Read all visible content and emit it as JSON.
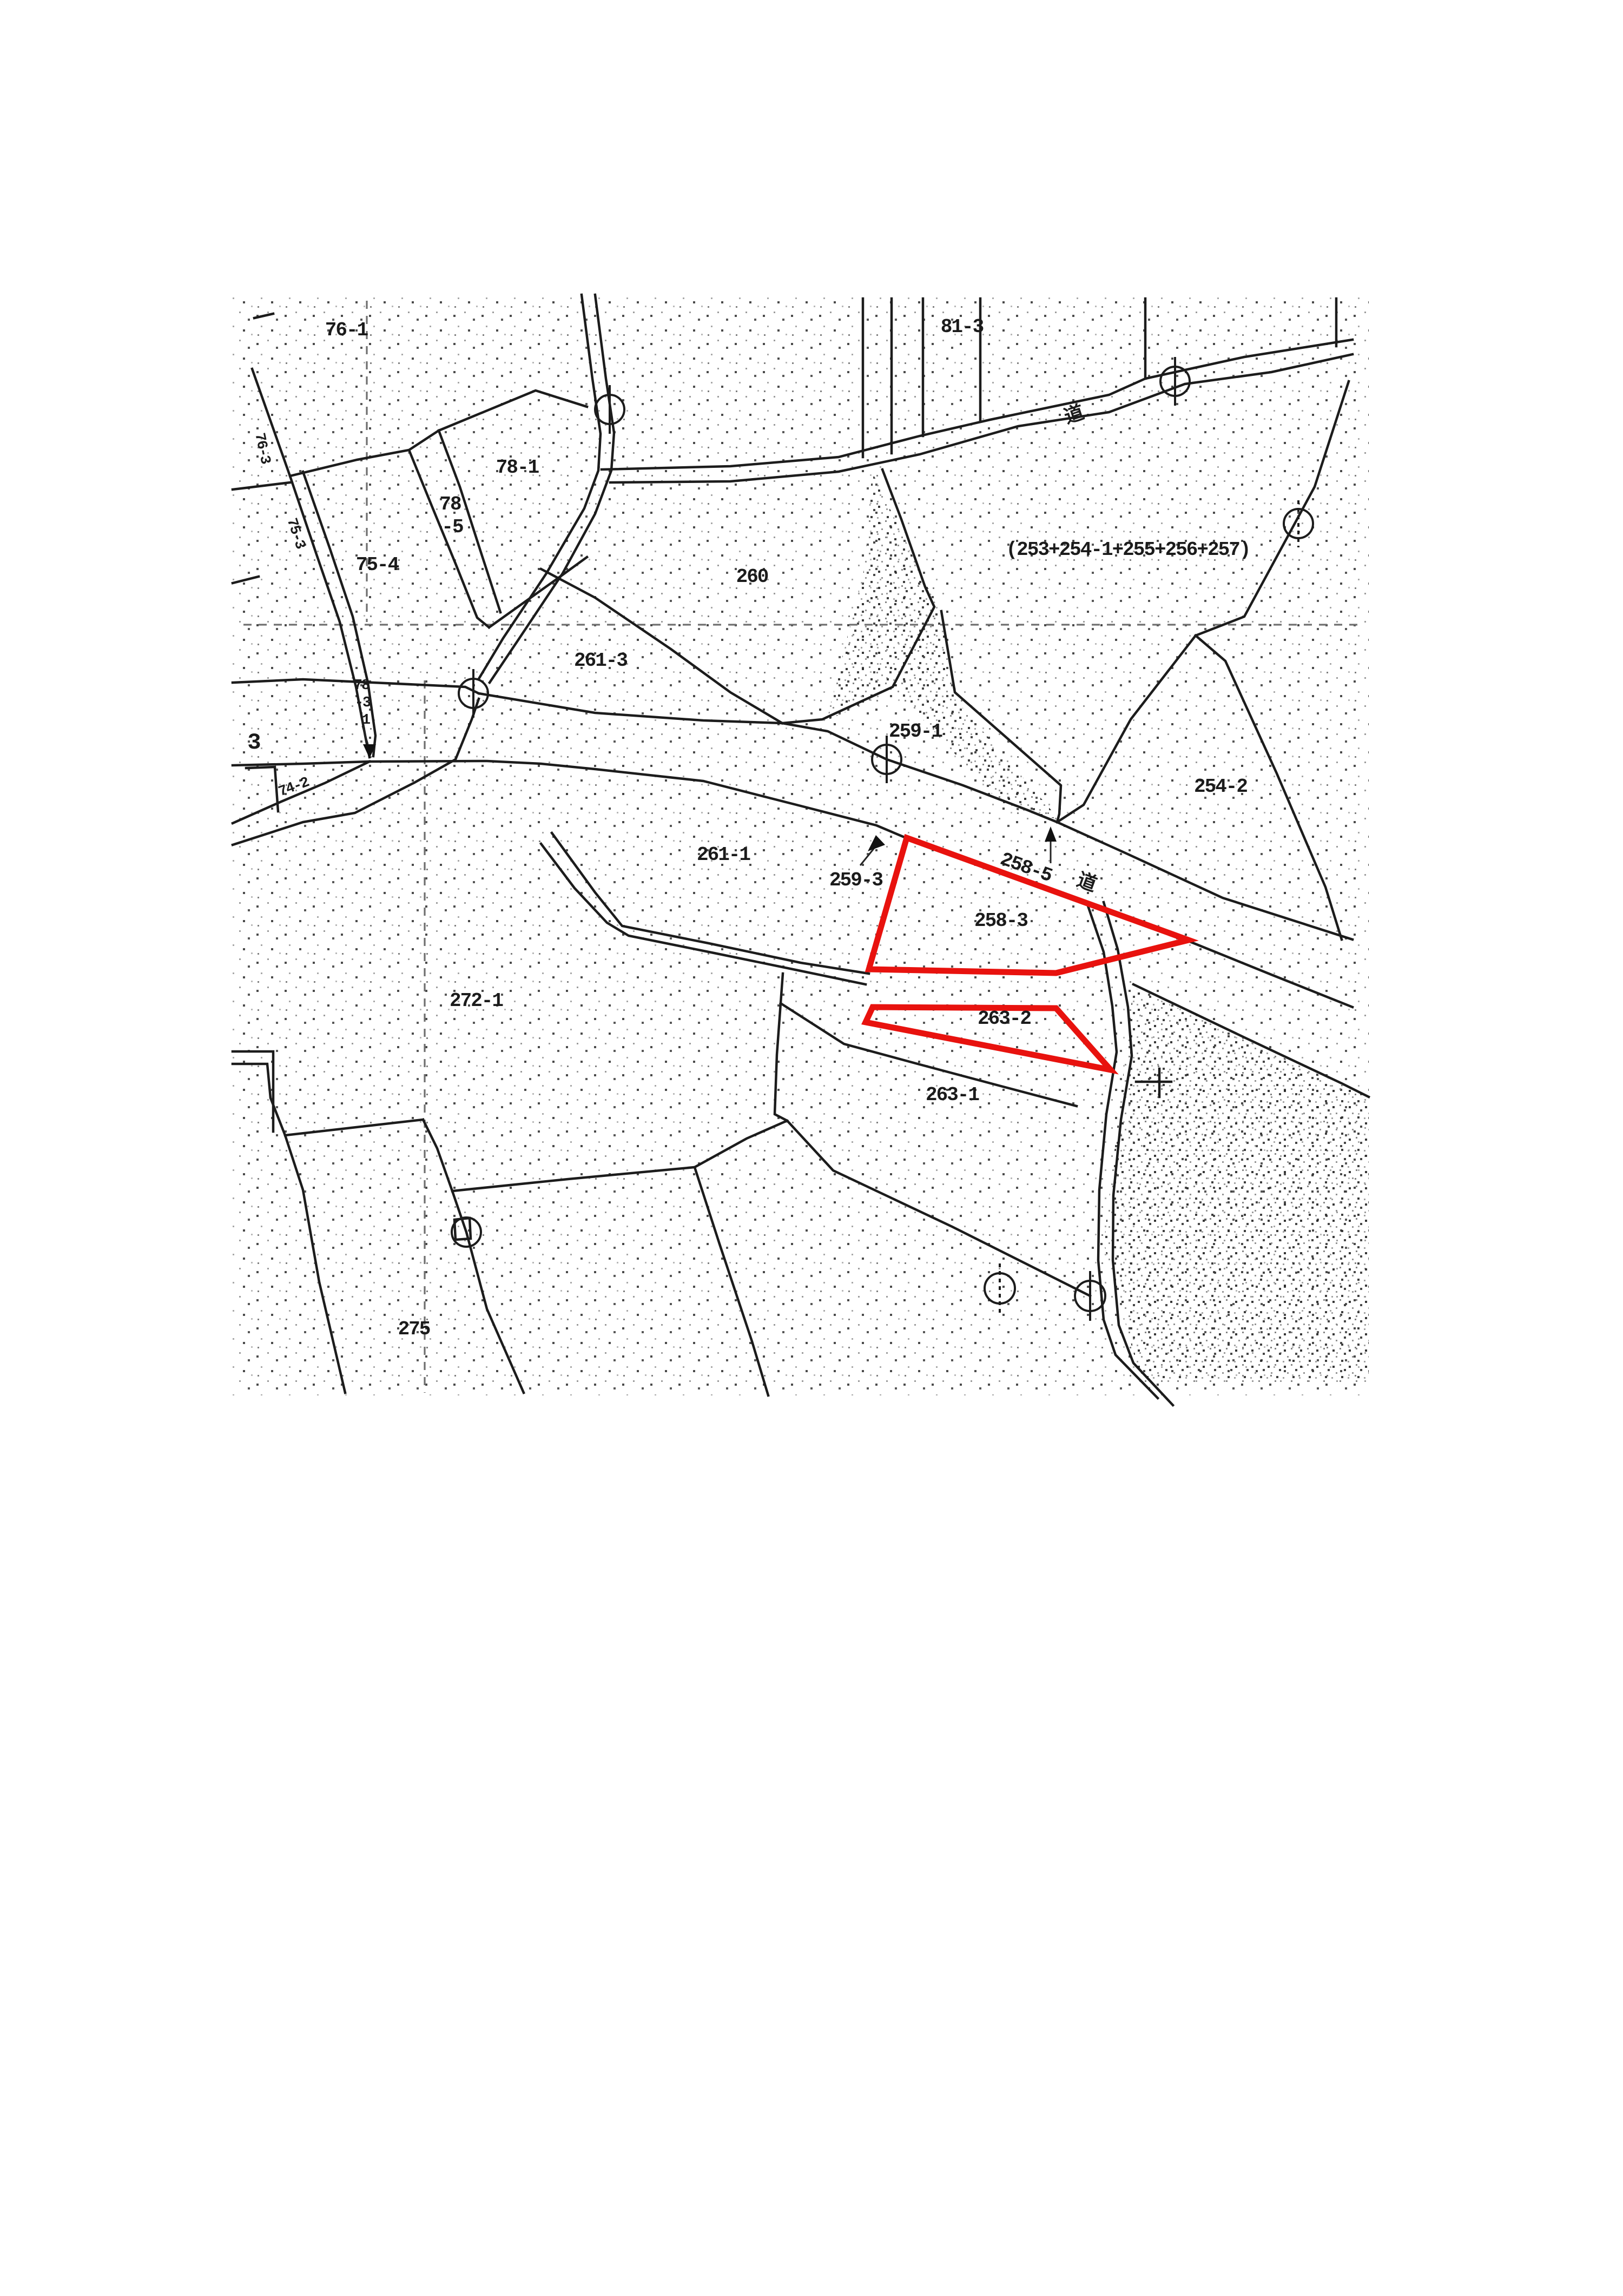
{
  "document": {
    "kind": "cadastral parcel map scan (公図)",
    "background_color": "#ffffff",
    "ink_color": "#1c1c1c",
    "highlight_color": "#e8120e",
    "highlighted_parcels": [
      "258-3",
      "263-2"
    ],
    "road_kanji": "道",
    "parcel_numbers": [
      "76-1",
      "81-3",
      "78-1",
      "78-5",
      "75-4",
      "76-3",
      "75-3",
      "260",
      "(253+254-1+255+256+257)",
      "261-3",
      "259-1",
      "254-2",
      "3",
      "74-2",
      "78-3-1",
      "261-1",
      "259-3",
      "258-5",
      "258-3",
      "272-1",
      "263-2",
      "263-1",
      "275"
    ]
  },
  "map": {
    "labels": [
      {
        "id": "l76_1",
        "text": "76-1"
      },
      {
        "id": "l81_3",
        "text": "81-3"
      },
      {
        "id": "lmichi1",
        "text": "道"
      },
      {
        "id": "l78_1",
        "text": "78-1"
      },
      {
        "id": "l78a",
        "text": "78"
      },
      {
        "id": "l78b",
        "text": "-5"
      },
      {
        "id": "l75_4",
        "text": "75-4"
      },
      {
        "id": "l76_3",
        "text": "76-3"
      },
      {
        "id": "l75_3",
        "text": "75-3"
      },
      {
        "id": "l260",
        "text": "260"
      },
      {
        "id": "lcomp",
        "text": "(253+254-1+255+256+257)"
      },
      {
        "id": "l261_3",
        "text": "261-3"
      },
      {
        "id": "l259_1",
        "text": "259-1"
      },
      {
        "id": "l254_2",
        "text": "254-2"
      },
      {
        "id": "l3",
        "text": "3"
      },
      {
        "id": "l74_2",
        "text": "74-2"
      },
      {
        "id": "l78c",
        "text": "78"
      },
      {
        "id": "l78d",
        "text": "-3"
      },
      {
        "id": "l78e",
        "text": "1"
      },
      {
        "id": "l261_1",
        "text": "261-1"
      },
      {
        "id": "l259_3",
        "text": "259-3"
      },
      {
        "id": "l258_5",
        "text": "258-5"
      },
      {
        "id": "lmichi2",
        "text": "道"
      },
      {
        "id": "l258_3",
        "text": "258-3"
      },
      {
        "id": "l272_1",
        "text": "272-1"
      },
      {
        "id": "l263_2",
        "text": "263-2"
      },
      {
        "id": "l263_1",
        "text": "263-1"
      },
      {
        "id": "l275",
        "text": "275"
      }
    ]
  }
}
